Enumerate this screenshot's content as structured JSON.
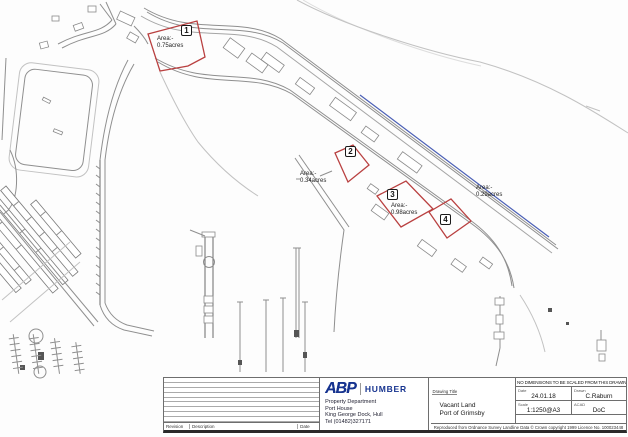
{
  "map": {
    "areas": [
      {
        "number": "1",
        "area_label": "Area:-",
        "acreage": "0.75acres"
      },
      {
        "number": "2",
        "area_label": "Area:-",
        "acreage": "0.34acres"
      },
      {
        "number": "3",
        "area_label": "Area:-",
        "acreage": "0.98acres"
      },
      {
        "number": "4",
        "area_label": "Area:-",
        "acreage": "0.29acres"
      }
    ],
    "colors": {
      "area_outline": "#b94040",
      "quay_line": "#4a5fb5",
      "drawing_line": "#8f8f8f"
    }
  },
  "title_block": {
    "revision_table": {
      "revision_header": "Revision",
      "description_header": "Description",
      "date_header": "Date"
    },
    "company": {
      "logo_text": "ABP",
      "logo_division": "HUMBER",
      "address_line1": "Property Department",
      "address_line2": "Port House",
      "address_line3": "King George Dock, Hull",
      "address_line4": "Tel (01482)327171"
    },
    "drawing": {
      "title_label": "Drawing Title",
      "title_line1": "Vacant Land",
      "title_line2": "Port of Grimsby"
    },
    "info": {
      "notice": "NO DIMENSIONS TO BE SCALED FROM THIS DRAWING",
      "date_label": "Date",
      "date_value": "24.01.18",
      "drawn_label": "Drawn",
      "drawn_value": "C.Raburn",
      "scale_label": "Scale",
      "scale_value": "1:1250@A3",
      "cad_label": "ACAD",
      "cad_value": "DoC"
    },
    "copyright": "Reproduced from Ordnance Survey Landline Data © Crown copyright 1999 Licence No. 100023448"
  }
}
